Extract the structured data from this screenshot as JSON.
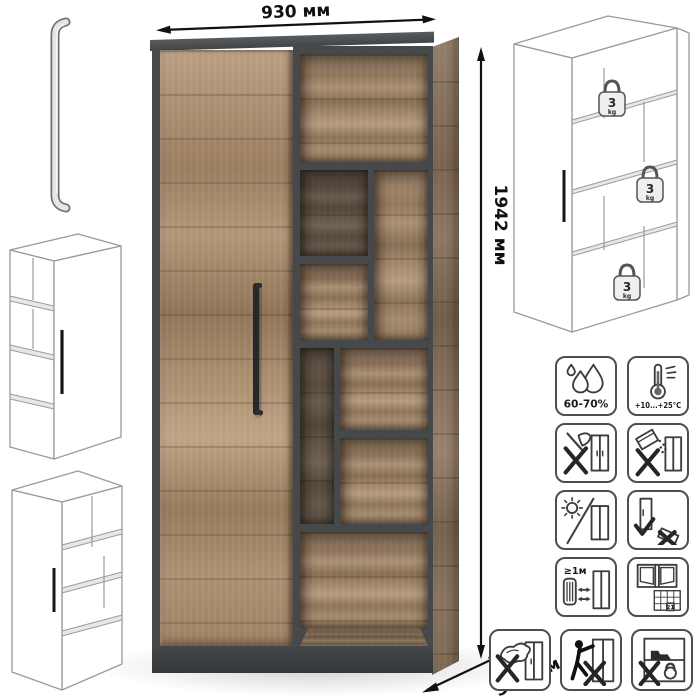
{
  "dimensions": {
    "width": "930 мм",
    "height": "1942 мм",
    "depth": "366 мм"
  },
  "load_badges": [
    {
      "value": "3",
      "unit": "kg"
    },
    {
      "value": "3",
      "unit": "kg"
    },
    {
      "value": "3",
      "unit": "kg"
    }
  ],
  "care": {
    "humidity": "60-70%",
    "temperature": "+10...+25°C",
    "heat_distance": "≥1м",
    "calendar_day": "21"
  },
  "colors": {
    "carcass": "#46494b",
    "wood": "#a98c6e",
    "outline": "#9a9a9a",
    "dimension_lines": "#111111"
  }
}
